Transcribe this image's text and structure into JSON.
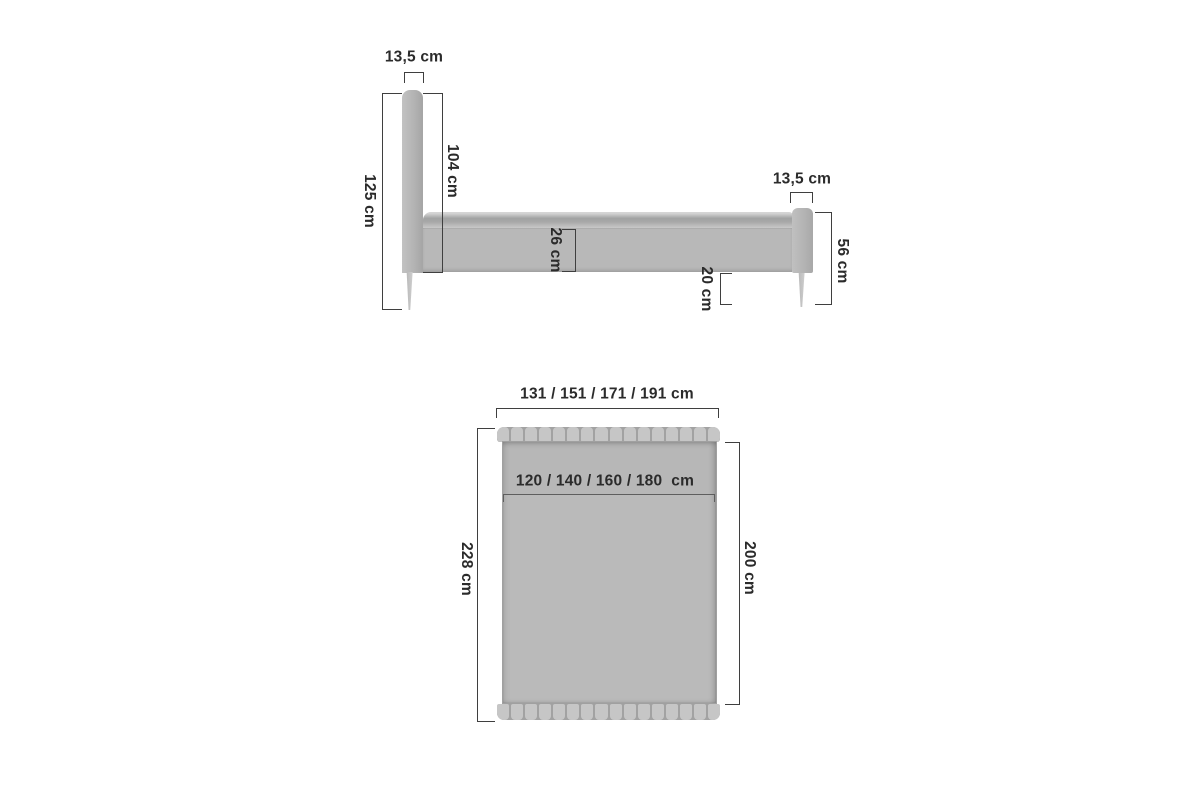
{
  "diagram": {
    "side_view": {
      "headboard_thickness_label": "13,5 cm",
      "total_height_label": "125 cm",
      "headboard_height_label": "104 cm",
      "frame_height_label": "26 cm",
      "footboard_thickness_label": "13,5 cm",
      "footboard_height_label": "56 cm",
      "underbed_clearance_label": "20 cm"
    },
    "top_view": {
      "overall_width_options_label": "131 / 151 / 171 / 191 cm",
      "mattress_width_options_label": "120 / 140 / 160 / 180  cm",
      "overall_length_label": "228 cm",
      "mattress_length_label": "200 cm"
    },
    "colors": {
      "background": "#ffffff",
      "furniture_fill": "#b7b7b7",
      "tuft_fill": "#c6c6c6",
      "dimension_line": "#3f3f3f",
      "text": "#2b2b2b"
    },
    "tuft_segment_count": 16
  }
}
